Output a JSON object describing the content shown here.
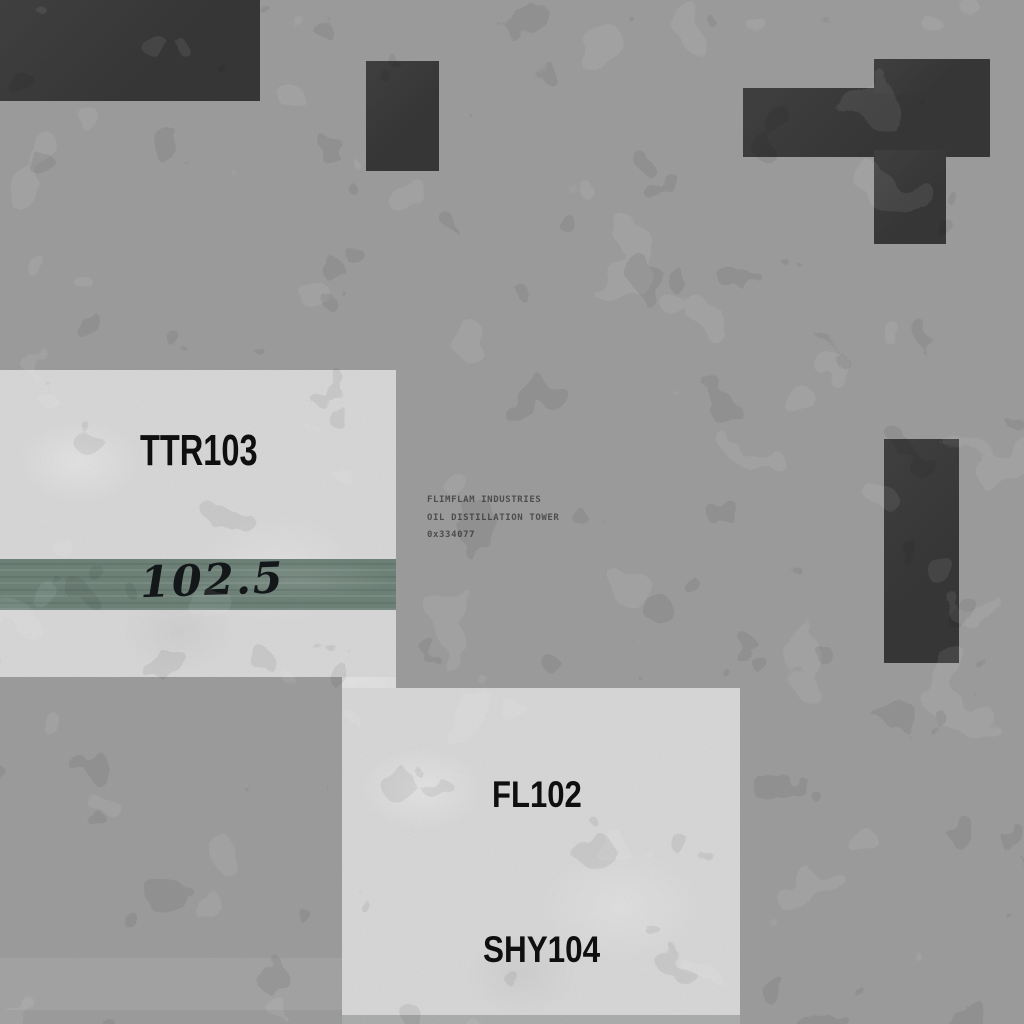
{
  "scene": {
    "company": "FLIMFLAM INDUSTRIES",
    "facility": "OIL DISTILLATION TOWER",
    "hex_id": "0x334077"
  },
  "slabs": {
    "ttr_label": "TTR103",
    "gauge_value": "102.5",
    "fl_label": "FL102",
    "shy_label": "SHY104"
  },
  "colors": {
    "background_concrete": "#9c9c9c",
    "dark_block": "#3a3a3a",
    "light_slab": "#d6d6d6",
    "stripe_green": "#6e8278",
    "slab_text": "#101010",
    "info_text": "#4e4e4e"
  }
}
